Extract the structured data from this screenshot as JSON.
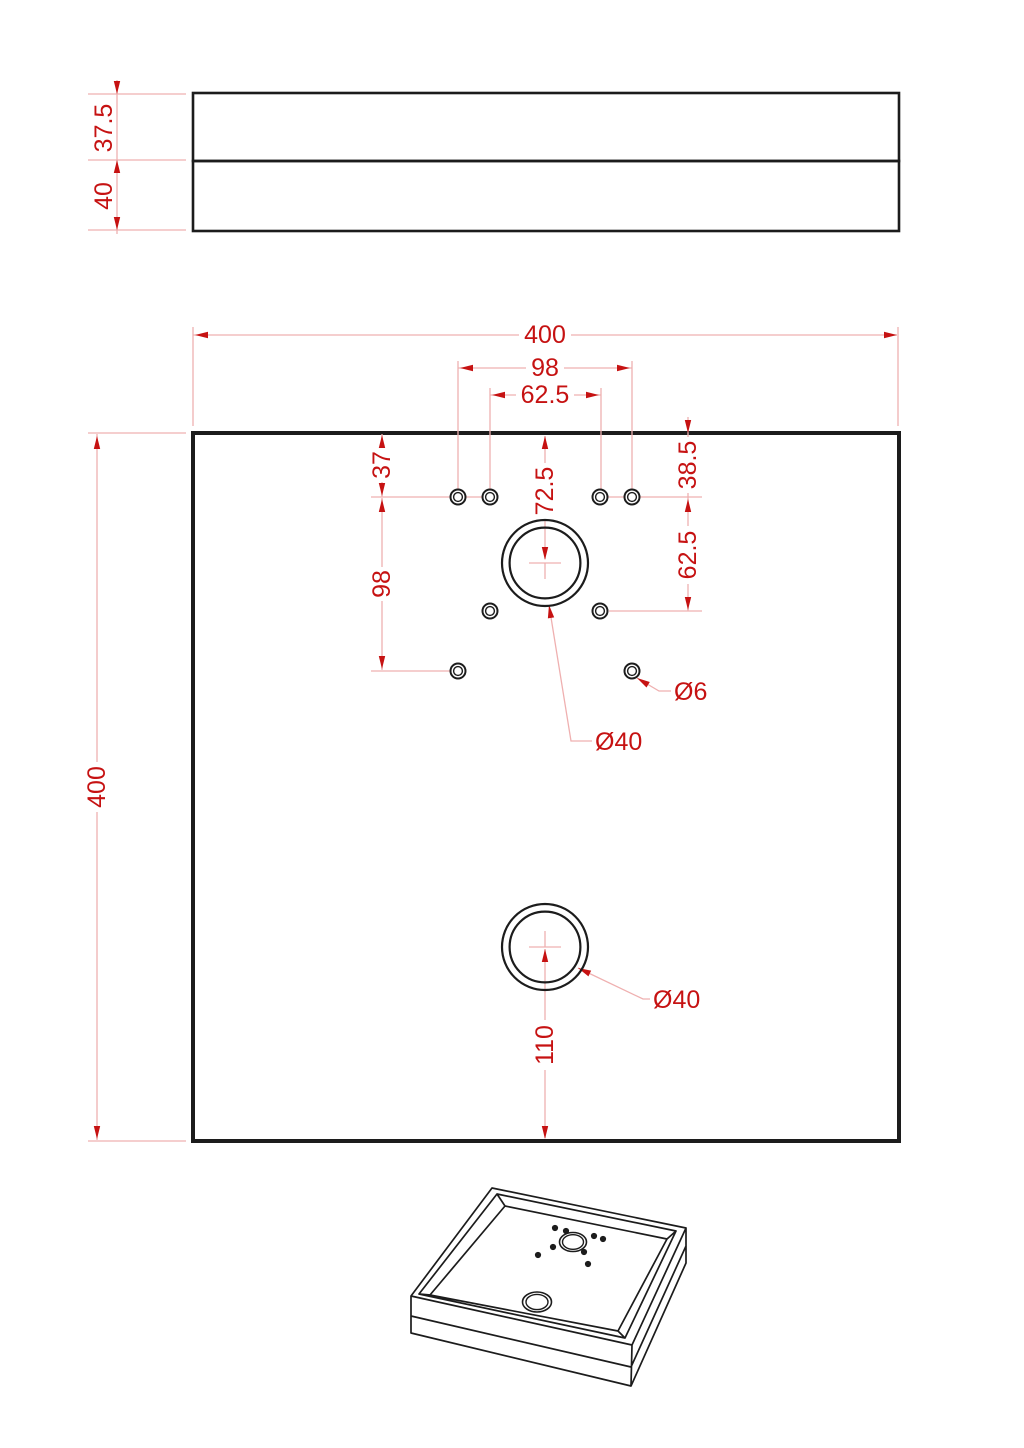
{
  "drawing": {
    "type": "technical-drawing",
    "colors": {
      "line": "#1c1c1c",
      "dimension_line": "#efb0b0",
      "dimension_text": "#c61212"
    },
    "side_view": {
      "upper_thickness": "37.5",
      "lower_thickness": "40"
    },
    "plan_view": {
      "width_mm": "400",
      "height_mm": "400",
      "bolt_span_outer": "98",
      "bolt_span_inner": "62.5",
      "offset_top_left": "37",
      "bolt_span_left": "98",
      "center_hole_offset": "72.5",
      "offset_top_right": "38.5",
      "bolt_span_right": "62.5",
      "small_hole_label": "Ø6",
      "center_hole_label": "Ø40",
      "drain_hole_label": "Ø40",
      "drain_offset_bottom": "110"
    }
  }
}
